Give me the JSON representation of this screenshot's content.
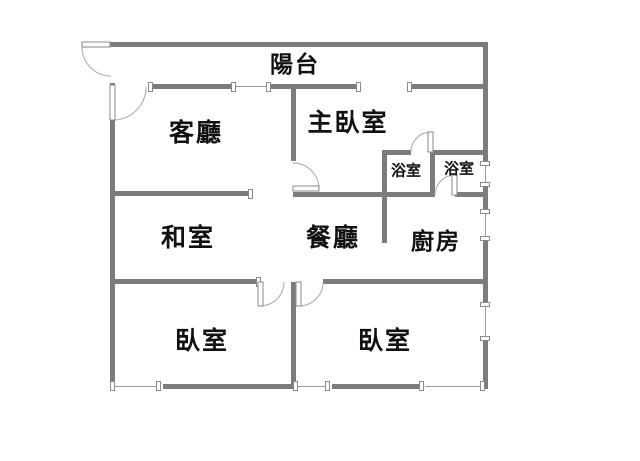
{
  "title": "apartment-floor-plan",
  "colors": {
    "wall": "#7c7c7c",
    "window_line": "#9a9a9a",
    "door_arc": "#b3b3b3",
    "text": "#111111",
    "background": "#ffffff"
  },
  "rooms": {
    "balcony": {
      "label": "陽台"
    },
    "living": {
      "label": "客廳"
    },
    "master": {
      "label": "主臥室"
    },
    "bath1": {
      "label": "浴室"
    },
    "bath2": {
      "label": "浴室"
    },
    "tatami": {
      "label": "和室"
    },
    "dining": {
      "label": "餐廳"
    },
    "kitchen": {
      "label": "廚房"
    },
    "bedroom_left": {
      "label": "臥室"
    },
    "bedroom_right": {
      "label": "臥室"
    }
  }
}
